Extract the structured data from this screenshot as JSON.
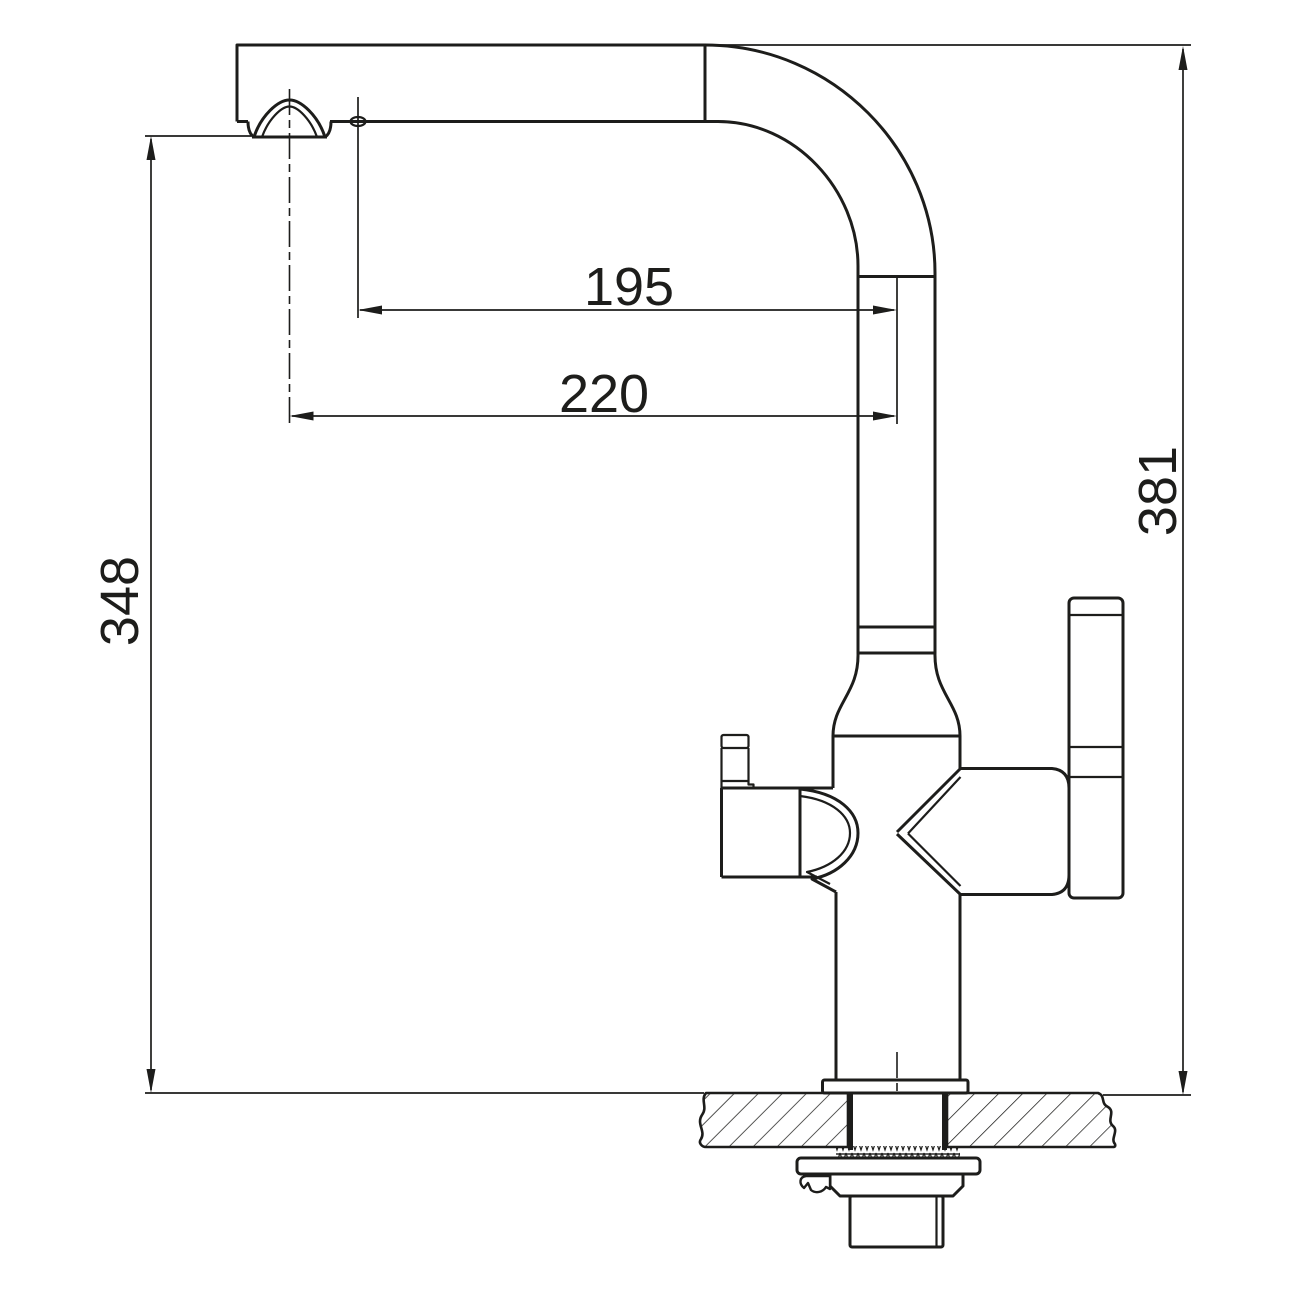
{
  "diagram": {
    "type": "technical-dimension-drawing",
    "subject": "kitchen faucet with filter, side elevation with mounting section",
    "background_color": "#ffffff",
    "line_color": "#1d1d1b",
    "dimensions": [
      {
        "id": "spout-reach-inner",
        "value": "195",
        "orientation": "horizontal"
      },
      {
        "id": "spout-reach-outer",
        "value": "220",
        "orientation": "horizontal"
      },
      {
        "id": "height-to-aerator",
        "value": "348",
        "orientation": "vertical"
      },
      {
        "id": "height-overall",
        "value": "381",
        "orientation": "vertical"
      }
    ]
  }
}
